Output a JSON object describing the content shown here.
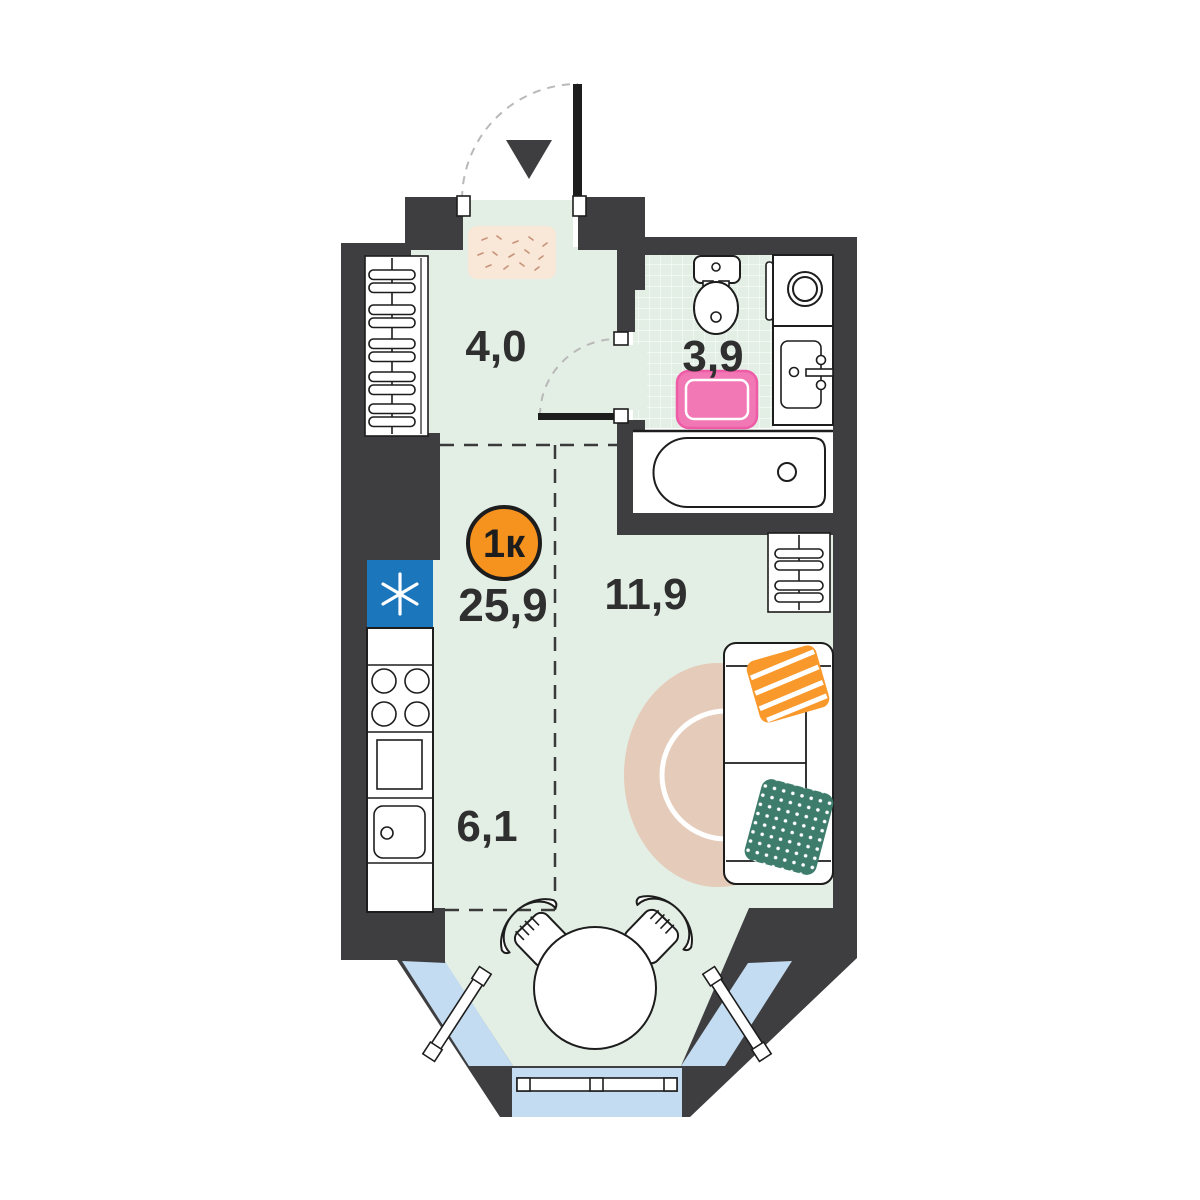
{
  "plan": {
    "badge": {
      "label": "1к"
    },
    "total_area": "25,9",
    "areas": {
      "hallway": "4,0",
      "bathroom": "3,9",
      "living": "11,9",
      "kitchen": "6,1"
    },
    "colors": {
      "wall": "#3E3E40",
      "floor": "#E3EFE5",
      "window": "#C4DCF1",
      "badge": "#F6921E",
      "fridge": "#1B76BC",
      "rug_pink": "#F177B5",
      "rug_pink_edge": "#EE5BA6",
      "rug_beige": "#E5CBB9",
      "pillow_orange": "#F9992C",
      "pillow_green": "#3E7C6C",
      "doormat": "#F9E8D8",
      "label": "#2F2F2F"
    }
  }
}
